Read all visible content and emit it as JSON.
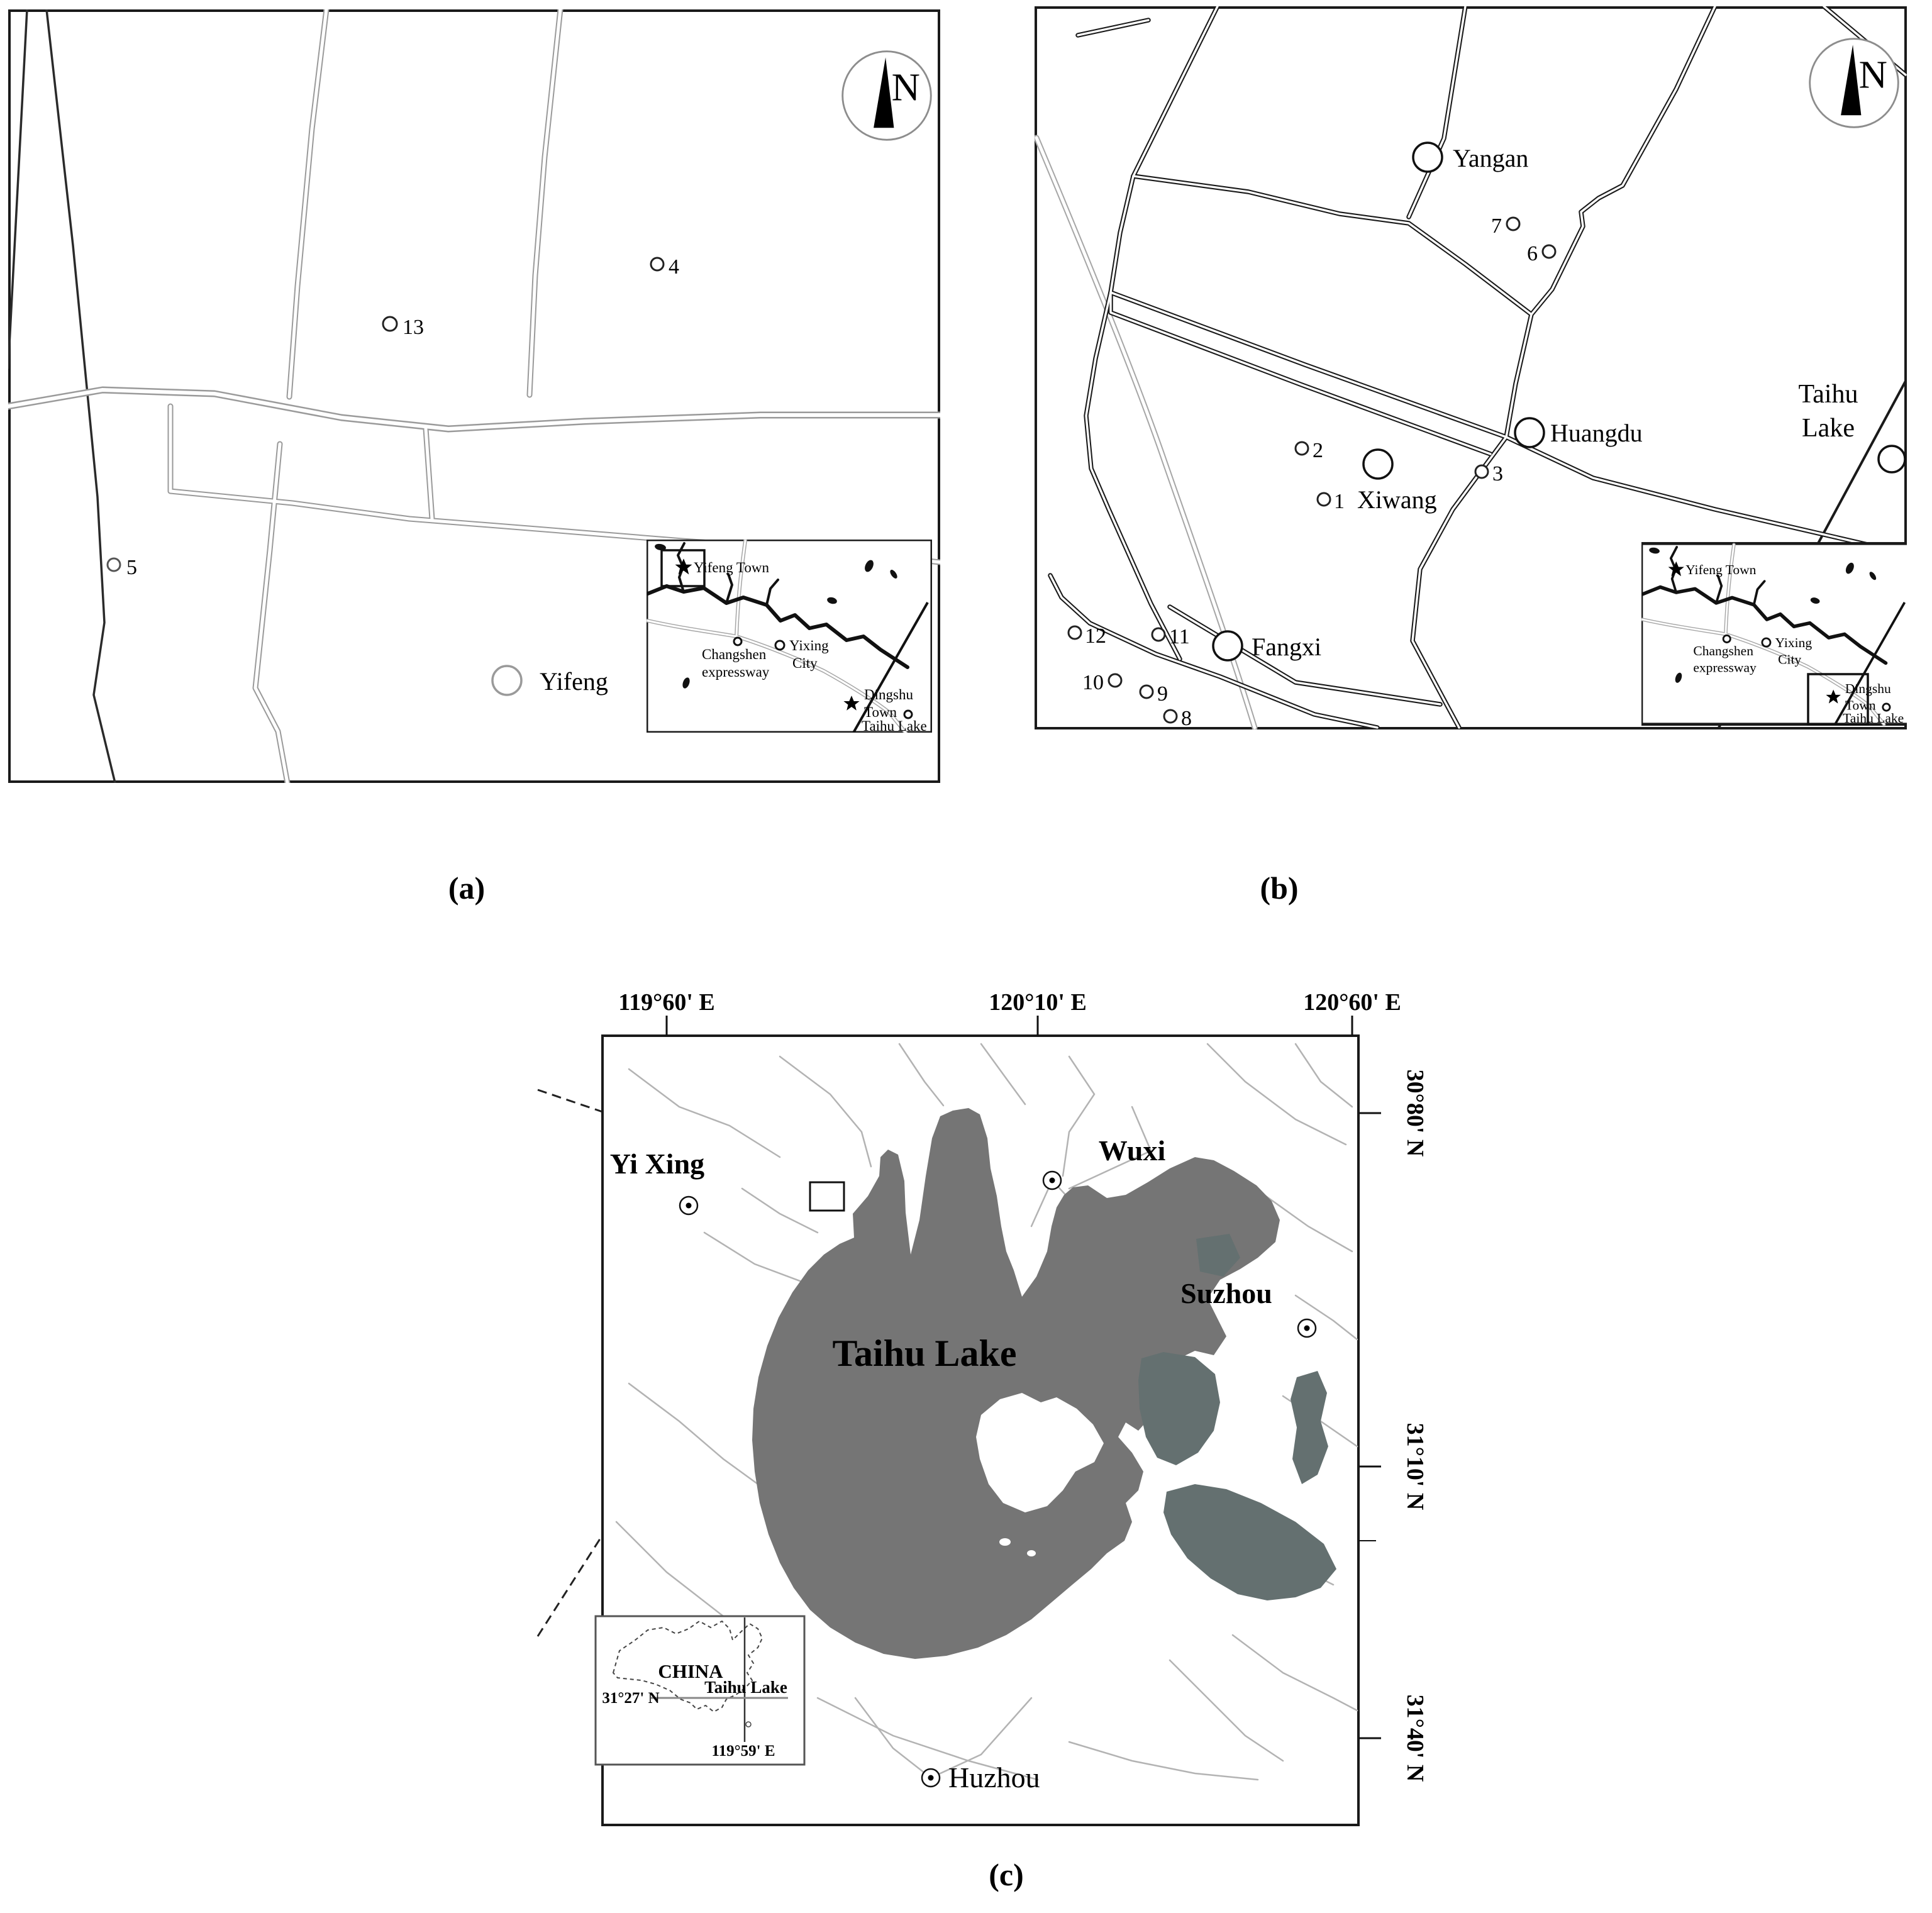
{
  "figure": {
    "caption_a": "(a)",
    "caption_b": "(b)",
    "caption_c": "(c)"
  },
  "compass": {
    "label": "N"
  },
  "panel_a": {
    "sites": {
      "s4": "4",
      "s13": "13",
      "s5": "5"
    },
    "towns": {
      "yifeng": "Yifeng"
    }
  },
  "panel_b": {
    "towns": {
      "yangan": "Yangan",
      "huangdu": "Huangdu",
      "xiwang": "Xiwang",
      "fangxi": "Fangxi"
    },
    "lake": {
      "line1": "Taihu",
      "line2": "Lake"
    },
    "sites": {
      "s1": "1",
      "s2": "2",
      "s3": "3",
      "s6": "6",
      "s7": "7",
      "s8": "8",
      "s9": "9",
      "s10": "10",
      "s11": "11",
      "s12": "12"
    }
  },
  "inset_ab": {
    "yifeng_town": "Yifeng Town",
    "changshen_line1": "Changshen",
    "changshen_line2": "expressway",
    "yixing_line1": "Yixing",
    "yixing_line2": "City",
    "dingshu_line1": "Dingshu",
    "dingshu_line2": "Town",
    "taihu_lake": "Taihu Lake"
  },
  "panel_c": {
    "x_axis": [
      "119°60' E",
      "120°10' E",
      "120°60' E"
    ],
    "y_axis": [
      "30°80' N",
      "31°10' N",
      "31°40' N"
    ],
    "cities": {
      "yixing": "Yi Xing",
      "wuxi": "Wuxi",
      "suzhou": "Suzhou",
      "huzhou": "Huzhou"
    },
    "lake_label": "Taihu Lake",
    "inset": {
      "country": "CHINA",
      "lake": "Taihu Lake",
      "lat": "31°27' N",
      "lon": "119°59' E"
    }
  },
  "colors": {
    "lake_gray": "#757575",
    "lake_dark": "#647070",
    "road_gray": "#9a9a9a",
    "expressway_gray": "#a6a6a6",
    "river_gray": "#b3b3b3"
  }
}
